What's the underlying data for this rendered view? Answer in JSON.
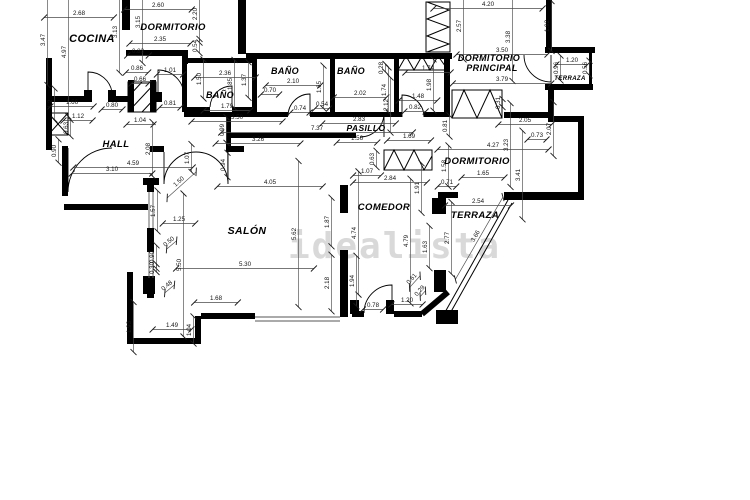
{
  "watermark": {
    "text": "idealista",
    "color": "#d9d9d9"
  },
  "plan": {
    "ink": "#000000",
    "rooms": [
      {
        "t": "COCINA",
        "x": 92,
        "y": 42,
        "fs": 11
      },
      {
        "t": "DORMITORIO",
        "x": 173,
        "y": 30,
        "fs": 9.5
      },
      {
        "t": "BAÑO",
        "x": 220,
        "y": 98,
        "fs": 9
      },
      {
        "t": "BAÑO",
        "x": 285,
        "y": 74,
        "fs": 9
      },
      {
        "t": "BAÑO",
        "x": 351,
        "y": 74,
        "fs": 9
      },
      {
        "t": "DORMITORIO",
        "x": 489,
        "y": 61,
        "fs": 9
      },
      {
        "t": "PRINCIPAL",
        "x": 492,
        "y": 71,
        "fs": 9
      },
      {
        "t": "TERRAZA",
        "x": 570,
        "y": 80,
        "fs": 6
      },
      {
        "t": "PASILLO",
        "x": 366,
        "y": 131,
        "fs": 8.5
      },
      {
        "t": "HALL",
        "x": 116,
        "y": 147,
        "fs": 9.5
      },
      {
        "t": "DORMITORIO",
        "x": 477,
        "y": 164,
        "fs": 9.5
      },
      {
        "t": "COMEDOR",
        "x": 384,
        "y": 210,
        "fs": 9.5
      },
      {
        "t": "SALÓN",
        "x": 247,
        "y": 234,
        "fs": 10.5
      },
      {
        "t": "TERRAZA",
        "x": 475,
        "y": 218,
        "fs": 9.5
      }
    ],
    "dims": [
      {
        "v": "2.68",
        "x": 79,
        "y": 15,
        "r": 0
      },
      {
        "v": "3.47",
        "x": 45,
        "y": 40,
        "r": -90
      },
      {
        "v": "4.97",
        "x": 66,
        "y": 52,
        "r": -90
      },
      {
        "v": "3.13",
        "x": 117,
        "y": 32,
        "r": -90
      },
      {
        "v": "2.60",
        "x": 158,
        "y": 7,
        "r": 0
      },
      {
        "v": "3.15",
        "x": 140,
        "y": 22,
        "r": -90
      },
      {
        "v": "2.20",
        "x": 197,
        "y": 14,
        "r": -90
      },
      {
        "v": "2.35",
        "x": 160,
        "y": 41,
        "r": 0
      },
      {
        "v": "0.83",
        "x": 138,
        "y": 53,
        "r": 0
      },
      {
        "v": "0.54",
        "x": 197,
        "y": 46,
        "r": -90
      },
      {
        "v": "0.86",
        "x": 137,
        "y": 70,
        "r": 0
      },
      {
        "v": "1.01",
        "x": 170,
        "y": 72,
        "r": 0
      },
      {
        "v": "0.66",
        "x": 140,
        "y": 81,
        "r": 0
      },
      {
        "v": "1.66",
        "x": 72,
        "y": 104,
        "r": 0
      },
      {
        "v": "0.80",
        "x": 112,
        "y": 107,
        "r": 0
      },
      {
        "v": "0.81",
        "x": 170,
        "y": 105,
        "r": 0
      },
      {
        "v": "1.2",
        "x": 52,
        "y": 104,
        "r": -90
      },
      {
        "v": "1.12",
        "x": 78,
        "y": 118,
        "r": 0
      },
      {
        "v": "0.63",
        "x": 68,
        "y": 128,
        "r": -90
      },
      {
        "v": "0.90",
        "x": 56,
        "y": 151,
        "r": -90
      },
      {
        "v": "2.36",
        "x": 225,
        "y": 75,
        "r": 0
      },
      {
        "v": "1.50",
        "x": 201,
        "y": 79,
        "r": -90
      },
      {
        "v": "1.85",
        "x": 232,
        "y": 84,
        "r": -90
      },
      {
        "v": "1.37",
        "x": 246,
        "y": 80,
        "r": -90
      },
      {
        "v": "1.79",
        "x": 227,
        "y": 108,
        "r": 0
      },
      {
        "v": "2.10",
        "x": 293,
        "y": 83,
        "r": 0
      },
      {
        "v": "0.70",
        "x": 270,
        "y": 92,
        "r": 0
      },
      {
        "v": "1.65",
        "x": 321,
        "y": 87,
        "r": -90
      },
      {
        "v": "0.74",
        "x": 300,
        "y": 110,
        "r": 0
      },
      {
        "v": "0.54",
        "x": 322,
        "y": 106,
        "r": 0
      },
      {
        "v": "2.02",
        "x": 360,
        "y": 95,
        "r": 0
      },
      {
        "v": "2.83",
        "x": 359,
        "y": 121,
        "r": 0
      },
      {
        "v": "0.28",
        "x": 383,
        "y": 68,
        "r": -90
      },
      {
        "v": "1.74",
        "x": 386,
        "y": 90,
        "r": -90
      },
      {
        "v": "2.12",
        "x": 388,
        "y": 105,
        "r": -90
      },
      {
        "v": "1.74",
        "x": 428,
        "y": 70,
        "r": 0
      },
      {
        "v": "1.98",
        "x": 431,
        "y": 85,
        "r": -90
      },
      {
        "v": "1.48",
        "x": 418,
        "y": 98,
        "r": 0
      },
      {
        "v": "0.82",
        "x": 415,
        "y": 109,
        "r": 0
      },
      {
        "v": "0.31",
        "x": 500,
        "y": 103,
        "r": -90
      },
      {
        "v": "2.57",
        "x": 461,
        "y": 26,
        "r": -90
      },
      {
        "v": "4.20",
        "x": 488,
        "y": 6,
        "r": 0
      },
      {
        "v": "3.38",
        "x": 510,
        "y": 37,
        "r": -90
      },
      {
        "v": "3.50",
        "x": 502,
        "y": 52,
        "r": 0
      },
      {
        "v": "3.79",
        "x": 502,
        "y": 81,
        "r": 0
      },
      {
        "v": "1.92",
        "x": 549,
        "y": 26,
        "r": -90
      },
      {
        "v": "1.20",
        "x": 572,
        "y": 62,
        "r": 0
      },
      {
        "v": "0.96",
        "x": 558,
        "y": 68,
        "r": -90
      },
      {
        "v": "0.56",
        "x": 587,
        "y": 68,
        "r": -90
      },
      {
        "v": "7.37",
        "x": 317,
        "y": 130,
        "r": 0
      },
      {
        "v": "1.56",
        "x": 357,
        "y": 140,
        "r": 0
      },
      {
        "v": "1.69",
        "x": 409,
        "y": 138,
        "r": 0
      },
      {
        "v": "0.99",
        "x": 224,
        "y": 130,
        "r": -90
      },
      {
        "v": "3.50",
        "x": 237,
        "y": 119,
        "r": 0
      },
      {
        "v": "3.26",
        "x": 258,
        "y": 141,
        "r": 0
      },
      {
        "v": "0.81",
        "x": 447,
        "y": 126,
        "r": -90
      },
      {
        "v": "1.04",
        "x": 140,
        "y": 122,
        "r": 0
      },
      {
        "v": "2.08",
        "x": 150,
        "y": 149,
        "r": -90
      },
      {
        "v": "4.59",
        "x": 133,
        "y": 165,
        "r": 0
      },
      {
        "v": "3.10",
        "x": 112,
        "y": 171,
        "r": 0
      },
      {
        "v": "1.07",
        "x": 189,
        "y": 158,
        "r": -90
      },
      {
        "v": "0.94",
        "x": 225,
        "y": 165,
        "r": -90
      },
      {
        "v": "1.50",
        "x": 180,
        "y": 183,
        "r": -42
      },
      {
        "v": "2.05",
        "x": 525,
        "y": 122,
        "r": 0
      },
      {
        "v": "0.73",
        "x": 537,
        "y": 137,
        "r": 0
      },
      {
        "v": "4.27",
        "x": 493,
        "y": 147,
        "r": 0
      },
      {
        "v": "3.23",
        "x": 508,
        "y": 145,
        "r": -90
      },
      {
        "v": "1.65",
        "x": 483,
        "y": 175,
        "r": 0
      },
      {
        "v": "3.41",
        "x": 520,
        "y": 175,
        "r": -90
      },
      {
        "v": "2.07",
        "x": 551,
        "y": 129,
        "r": -90
      },
      {
        "v": "0.71",
        "x": 447,
        "y": 184,
        "r": 0
      },
      {
        "v": "1.58",
        "x": 446,
        "y": 166,
        "r": -90
      },
      {
        "v": "1.91",
        "x": 419,
        "y": 188,
        "r": -90
      },
      {
        "v": "1.07",
        "x": 367,
        "y": 173,
        "r": 0
      },
      {
        "v": "2.84",
        "x": 390,
        "y": 180,
        "r": 0
      },
      {
        "v": "0.63",
        "x": 374,
        "y": 159,
        "r": -90
      },
      {
        "v": "4.74",
        "x": 356,
        "y": 233,
        "r": -90
      },
      {
        "v": "4.79",
        "x": 408,
        "y": 241,
        "r": -90
      },
      {
        "v": "1.63",
        "x": 427,
        "y": 247,
        "r": -90
      },
      {
        "v": "1.87",
        "x": 329,
        "y": 222,
        "r": -90
      },
      {
        "v": "2.54",
        "x": 478,
        "y": 203,
        "r": 0
      },
      {
        "v": "2.77",
        "x": 449,
        "y": 238,
        "r": -90
      },
      {
        "v": "3.66",
        "x": 477,
        "y": 237,
        "r": -60
      },
      {
        "v": "4.05",
        "x": 270,
        "y": 184,
        "r": 0
      },
      {
        "v": "1.25",
        "x": 179,
        "y": 221,
        "r": 0
      },
      {
        "v": "5.62",
        "x": 296,
        "y": 234,
        "r": -90
      },
      {
        "v": "5.30",
        "x": 245,
        "y": 266,
        "r": 0
      },
      {
        "v": "5.50",
        "x": 181,
        "y": 265,
        "r": -90
      },
      {
        "v": "1.57",
        "x": 155,
        "y": 211,
        "r": -90
      },
      {
        "v": "0.50",
        "x": 170,
        "y": 243,
        "r": -40
      },
      {
        "v": "0.90",
        "x": 154,
        "y": 257,
        "r": -90
      },
      {
        "v": "0.30",
        "x": 154,
        "y": 268,
        "r": -90
      },
      {
        "v": "0.48",
        "x": 168,
        "y": 287,
        "r": -40
      },
      {
        "v": "1.93",
        "x": 131,
        "y": 327,
        "r": -90
      },
      {
        "v": "1.49",
        "x": 172,
        "y": 327,
        "r": 0
      },
      {
        "v": "1.04",
        "x": 191,
        "y": 330,
        "r": -90
      },
      {
        "v": "1.68",
        "x": 216,
        "y": 300,
        "r": 0
      },
      {
        "v": "2.18",
        "x": 329,
        "y": 283,
        "r": -90
      },
      {
        "v": "1.94",
        "x": 354,
        "y": 281,
        "r": -90
      },
      {
        "v": "0.78",
        "x": 373,
        "y": 307,
        "r": 0
      },
      {
        "v": "1.20",
        "x": 407,
        "y": 302,
        "r": 0
      },
      {
        "v": "0.61",
        "x": 413,
        "y": 280,
        "r": -48
      },
      {
        "v": "0.29",
        "x": 421,
        "y": 292,
        "r": -48
      }
    ]
  }
}
